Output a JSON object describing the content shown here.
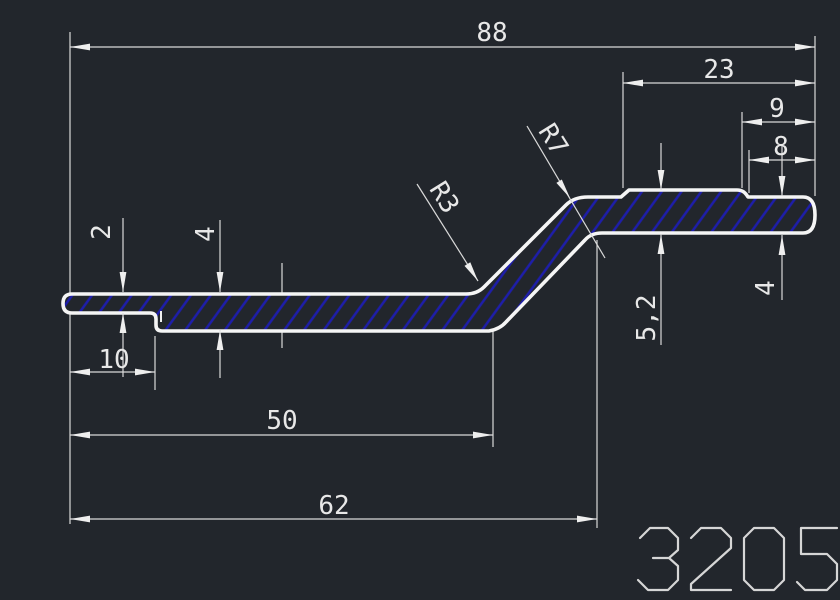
{
  "app": {
    "view": "cad-drawing-viewport"
  },
  "drawing": {
    "part_number": "3205",
    "labels": {
      "d88": "88",
      "d23": "23",
      "d9": "9",
      "d8": "8",
      "d2": "2",
      "d4_left": "4",
      "d10": "10",
      "d50": "50",
      "d62": "62",
      "d5_2": "5,2",
      "d4_right": "4",
      "r3": "R3",
      "r7": "R7"
    },
    "colors": {
      "background": "#22262c",
      "geometry_line": "#f5f5f5",
      "dimension_line": "#d9d9d9",
      "hatch": "#1e1eaa",
      "dimension_text": "#e8e8e8",
      "part_number_text": "#d6d6d6"
    }
  }
}
